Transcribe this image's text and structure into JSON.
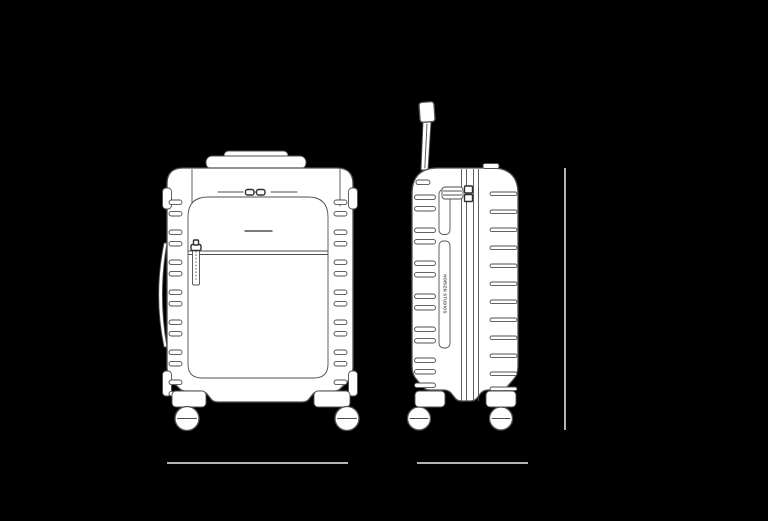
{
  "colors": {
    "background": "#000000",
    "fill": "#ffffff",
    "line": "#4f4f4f",
    "line_dark": "#2f2f2f",
    "dimension_line": "#b3b3b3"
  },
  "side_view": {
    "brand_label": "HORIZN STUDIOS"
  }
}
